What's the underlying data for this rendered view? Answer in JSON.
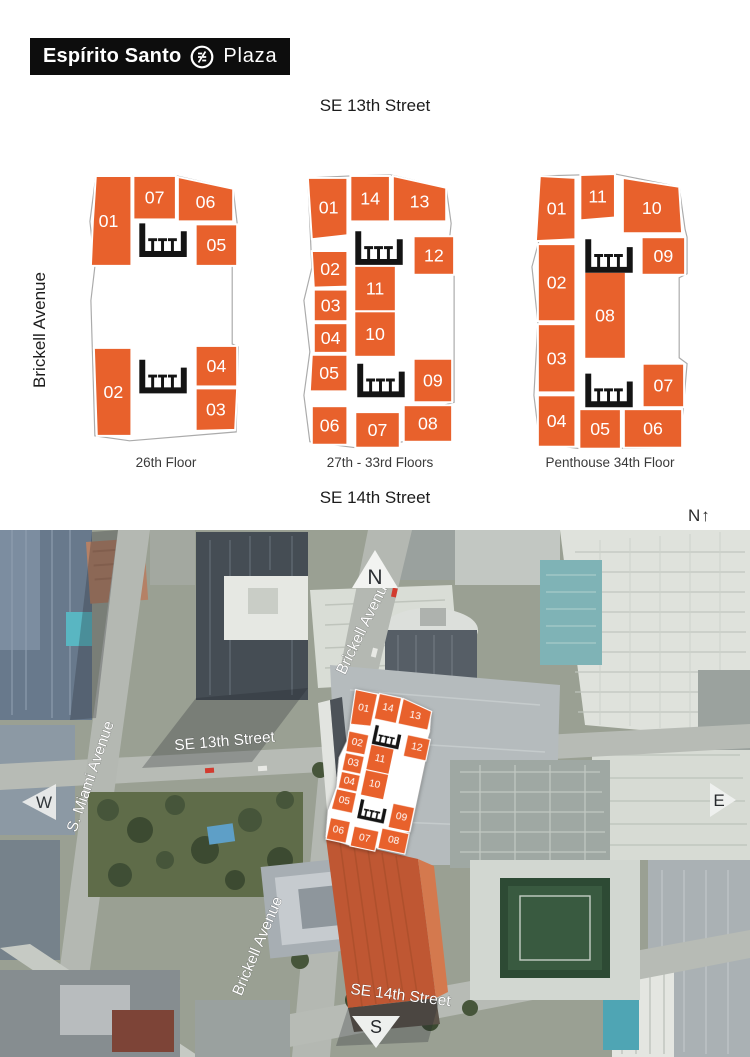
{
  "logo": {
    "text_bold": "Espírito Santo",
    "text_light": "Plaza"
  },
  "header": {
    "top_street": "SE 13th Street",
    "left_street": "Brickell Avenue",
    "bottom_street": "SE 14th Street",
    "compass_note": "N↑"
  },
  "plans": [
    {
      "id": "floor-26",
      "caption": "26th Floor",
      "units": [
        "01",
        "07",
        "06",
        "05",
        "02",
        "04",
        "03"
      ]
    },
    {
      "id": "floor-27-33",
      "caption": "27th - 33rd Floors",
      "units": [
        "01",
        "14",
        "13",
        "02",
        "12",
        "03",
        "11",
        "04",
        "10",
        "05",
        "09",
        "06",
        "07",
        "08"
      ]
    },
    {
      "id": "floor-34",
      "caption": "Penthouse 34th Floor",
      "units": [
        "01",
        "11",
        "10",
        "09",
        "02",
        "08",
        "03",
        "07",
        "04",
        "05",
        "06"
      ]
    }
  ],
  "aerial": {
    "labels": {
      "brickell_upper": "Brickell Avenue",
      "se13": "SE 13th Street",
      "s_miami": "S. Miami Avenue",
      "brickell_lower": "Brickell Avenue",
      "se14": "SE 14th Street"
    },
    "compass": {
      "n": "N",
      "s": "S",
      "e": "E",
      "w": "W"
    }
  },
  "colors": {
    "accent": "#E8612C",
    "logo_bg": "#0d0d0d",
    "facade_orange": "#bf5733"
  }
}
